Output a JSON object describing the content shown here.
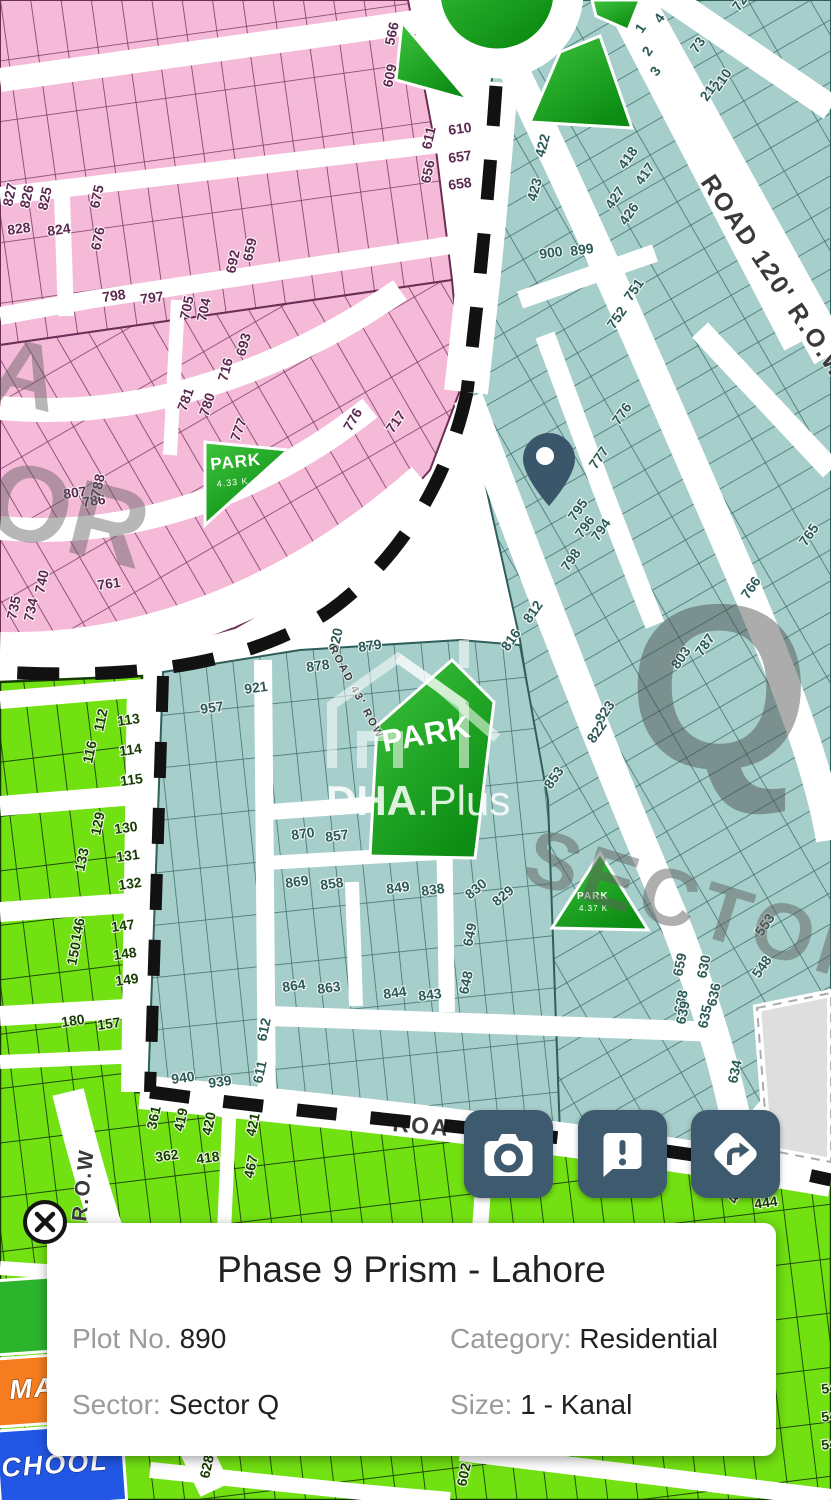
{
  "card": {
    "title": "Phase 9 Prism - Lahore",
    "fields": [
      {
        "label": "Plot No.",
        "value": "890"
      },
      {
        "label": "Category:",
        "value": "Residential"
      },
      {
        "label": "Sector:",
        "value": "Sector Q"
      },
      {
        "label": "Size:",
        "value": "1 - Kanal"
      }
    ]
  },
  "buttons": [
    {
      "name": "camera"
    },
    {
      "name": "feedback"
    },
    {
      "name": "directions"
    }
  ],
  "colors": {
    "accent": "#3d5a6e",
    "pin": "#3a566b",
    "plots_pink": "#f4bad8",
    "plots_teal": "#a6cecb",
    "plots_green": "#72e112",
    "park_green": "#0f9d14",
    "masjid_orange": "#f57d1f",
    "school_blue": "#2257e6",
    "vacant_gray": "#dedede",
    "boundary_dash": "#121212",
    "card_bg": "#ffffff",
    "label_gray": "#9b9b9b",
    "value_black": "#212121"
  },
  "map": {
    "watermarks": {
      "q": "Q",
      "sector": "SECTOR",
      "side_or": "OR",
      "side_a": "A",
      "brand_bold": "DHA",
      "brand_rest": ".Plus"
    },
    "road_labels": [
      {
        "t": "ROAD 120' R.O.W",
        "x": 700,
        "y": 182,
        "r": 56,
        "s": 25
      },
      {
        "t": "ROAD 43' ROW",
        "x": 329,
        "y": 648,
        "r": 62,
        "s": 11
      },
      {
        "t": "ROA",
        "x": 392,
        "y": 1131,
        "r": 5,
        "s": 23
      },
      {
        "t": "R.O.W",
        "x": 86,
        "y": 1222,
        "r": -84,
        "s": 21
      }
    ],
    "park_labels": [
      {
        "t": "PARK",
        "x": 384,
        "y": 752,
        "r": -10,
        "s": 31,
        "b": true
      },
      {
        "t": "PARK",
        "x": 211,
        "y": 470,
        "r": -6,
        "s": 17,
        "b": true
      },
      {
        "t": "4.33 K",
        "x": 217,
        "y": 487,
        "r": -6,
        "s": 9
      },
      {
        "t": "PARK",
        "x": 577,
        "y": 899,
        "r": 0,
        "s": 10,
        "b": true
      },
      {
        "t": "4.37 K",
        "x": 579,
        "y": 911,
        "r": 0,
        "s": 8
      }
    ],
    "facility_labels": [
      {
        "t": "MAS",
        "x": 10,
        "y": 1399,
        "r": -4,
        "s": 27
      },
      {
        "t": "CHOOL",
        "x": 2,
        "y": 1477,
        "r": -4,
        "s": 27
      }
    ],
    "plot_labels": [
      {
        "t": "566",
        "x": 394,
        "y": 46,
        "r": -78,
        "c": "p"
      },
      {
        "t": "609",
        "x": 392,
        "y": 88,
        "r": -78,
        "c": "p"
      },
      {
        "t": "610",
        "x": 449,
        "y": 135,
        "r": -8,
        "c": "p"
      },
      {
        "t": "611",
        "x": 431,
        "y": 150,
        "r": -78,
        "c": "p"
      },
      {
        "t": "657",
        "x": 449,
        "y": 163,
        "r": -8,
        "c": "p"
      },
      {
        "t": "656",
        "x": 430,
        "y": 184,
        "r": -78,
        "c": "p"
      },
      {
        "t": "658",
        "x": 449,
        "y": 190,
        "r": -8,
        "c": "p"
      },
      {
        "t": "827",
        "x": 12,
        "y": 207,
        "r": -78,
        "c": "p"
      },
      {
        "t": "826",
        "x": 29,
        "y": 209,
        "r": -78,
        "c": "p"
      },
      {
        "t": "825",
        "x": 47,
        "y": 211,
        "r": -78,
        "c": "p"
      },
      {
        "t": "828",
        "x": 8,
        "y": 235,
        "r": -8,
        "c": "p"
      },
      {
        "t": "824",
        "x": 48,
        "y": 236,
        "r": -8,
        "c": "p"
      },
      {
        "t": "675",
        "x": 99,
        "y": 209,
        "r": -78,
        "c": "p"
      },
      {
        "t": "676",
        "x": 100,
        "y": 251,
        "r": -78,
        "c": "p"
      },
      {
        "t": "692",
        "x": 235,
        "y": 274,
        "r": -78,
        "c": "p"
      },
      {
        "t": "659",
        "x": 252,
        "y": 262,
        "r": -78,
        "c": "p"
      },
      {
        "t": "798",
        "x": 103,
        "y": 302,
        "r": -8,
        "c": "p"
      },
      {
        "t": "797",
        "x": 141,
        "y": 304,
        "r": -8,
        "c": "p"
      },
      {
        "t": "705",
        "x": 189,
        "y": 320,
        "r": -78,
        "c": "p"
      },
      {
        "t": "704",
        "x": 206,
        "y": 322,
        "r": -78,
        "c": "p"
      },
      {
        "t": "716",
        "x": 227,
        "y": 382,
        "r": -75,
        "c": "p"
      },
      {
        "t": "693",
        "x": 245,
        "y": 357,
        "r": -75,
        "c": "p"
      },
      {
        "t": "781",
        "x": 186,
        "y": 412,
        "r": -70,
        "c": "p"
      },
      {
        "t": "780",
        "x": 208,
        "y": 417,
        "r": -72,
        "c": "p"
      },
      {
        "t": "777",
        "x": 239,
        "y": 442,
        "r": -70,
        "c": "p"
      },
      {
        "t": "776",
        "x": 351,
        "y": 432,
        "r": -60,
        "c": "p"
      },
      {
        "t": "717",
        "x": 393,
        "y": 434,
        "r": -55,
        "c": "p"
      },
      {
        "t": "786",
        "x": 83,
        "y": 507,
        "r": -8,
        "c": "p"
      },
      {
        "t": "788",
        "x": 100,
        "y": 498,
        "r": -78,
        "c": "p"
      },
      {
        "t": "807",
        "x": 64,
        "y": 499,
        "r": -8,
        "c": "p"
      },
      {
        "t": "761",
        "x": 98,
        "y": 590,
        "r": -8,
        "c": "p"
      },
      {
        "t": "740",
        "x": 44,
        "y": 594,
        "r": -78,
        "c": "p"
      },
      {
        "t": "735",
        "x": 16,
        "y": 620,
        "r": -78,
        "c": "p"
      },
      {
        "t": "734",
        "x": 33,
        "y": 622,
        "r": -78,
        "c": "p"
      },
      {
        "t": "4",
        "x": 661,
        "y": 24,
        "r": -55,
        "c": "t"
      },
      {
        "t": "1",
        "x": 642,
        "y": 34,
        "r": -55,
        "c": "t"
      },
      {
        "t": "2",
        "x": 649,
        "y": 57,
        "r": -55,
        "c": "t"
      },
      {
        "t": "3",
        "x": 657,
        "y": 77,
        "r": -55,
        "c": "t"
      },
      {
        "t": "72",
        "x": 739,
        "y": 12,
        "r": -55,
        "c": "t"
      },
      {
        "t": "73",
        "x": 697,
        "y": 54,
        "r": -55,
        "c": "t"
      },
      {
        "t": "211",
        "x": 707,
        "y": 102,
        "r": -55,
        "c": "t"
      },
      {
        "t": "210",
        "x": 719,
        "y": 92,
        "r": -55,
        "c": "t"
      },
      {
        "t": "418",
        "x": 625,
        "y": 170,
        "r": -55,
        "c": "t"
      },
      {
        "t": "417",
        "x": 642,
        "y": 186,
        "r": -55,
        "c": "t"
      },
      {
        "t": "427",
        "x": 612,
        "y": 210,
        "r": -55,
        "c": "t"
      },
      {
        "t": "426",
        "x": 626,
        "y": 226,
        "r": -55,
        "c": "t"
      },
      {
        "t": "422",
        "x": 544,
        "y": 158,
        "r": -75,
        "c": "t"
      },
      {
        "t": "423",
        "x": 536,
        "y": 202,
        "r": -75,
        "c": "t"
      },
      {
        "t": "900",
        "x": 540,
        "y": 259,
        "r": -8,
        "c": "t"
      },
      {
        "t": "899",
        "x": 571,
        "y": 256,
        "r": -8,
        "c": "t"
      },
      {
        "t": "751",
        "x": 631,
        "y": 302,
        "r": -55,
        "c": "t"
      },
      {
        "t": "752",
        "x": 614,
        "y": 330,
        "r": -55,
        "c": "t"
      },
      {
        "t": "776",
        "x": 619,
        "y": 426,
        "r": -55,
        "c": "t"
      },
      {
        "t": "777",
        "x": 596,
        "y": 470,
        "r": -55,
        "c": "t"
      },
      {
        "t": "795",
        "x": 575,
        "y": 522,
        "r": -55,
        "c": "t"
      },
      {
        "t": "796",
        "x": 582,
        "y": 539,
        "r": -55,
        "c": "t"
      },
      {
        "t": "794",
        "x": 598,
        "y": 542,
        "r": -55,
        "c": "t"
      },
      {
        "t": "798",
        "x": 568,
        "y": 572,
        "r": -55,
        "c": "t"
      },
      {
        "t": "812",
        "x": 530,
        "y": 624,
        "r": -55,
        "c": "t"
      },
      {
        "t": "816",
        "x": 508,
        "y": 652,
        "r": -55,
        "c": "t"
      },
      {
        "t": "765",
        "x": 806,
        "y": 547,
        "r": -55,
        "c": "t"
      },
      {
        "t": "766",
        "x": 748,
        "y": 600,
        "r": -55,
        "c": "t"
      },
      {
        "t": "787",
        "x": 702,
        "y": 657,
        "r": -55,
        "c": "t"
      },
      {
        "t": "803",
        "x": 678,
        "y": 670,
        "r": -55,
        "c": "t"
      },
      {
        "t": "823",
        "x": 602,
        "y": 724,
        "r": -55,
        "c": "t"
      },
      {
        "t": "822",
        "x": 594,
        "y": 744,
        "r": -55,
        "c": "t"
      },
      {
        "t": "853",
        "x": 551,
        "y": 790,
        "r": -55,
        "c": "t"
      },
      {
        "t": "921",
        "x": 245,
        "y": 694,
        "r": -8,
        "c": "t"
      },
      {
        "t": "957",
        "x": 201,
        "y": 714,
        "r": -8,
        "c": "t"
      },
      {
        "t": "879",
        "x": 359,
        "y": 652,
        "r": -8,
        "c": "t"
      },
      {
        "t": "920",
        "x": 338,
        "y": 652,
        "r": -78,
        "c": "t"
      },
      {
        "t": "878",
        "x": 307,
        "y": 672,
        "r": -8,
        "c": "t"
      },
      {
        "t": "870",
        "x": 292,
        "y": 840,
        "r": -8,
        "c": "t"
      },
      {
        "t": "857",
        "x": 326,
        "y": 842,
        "r": -8,
        "c": "t"
      },
      {
        "t": "869",
        "x": 286,
        "y": 888,
        "r": -8,
        "c": "t"
      },
      {
        "t": "858",
        "x": 321,
        "y": 890,
        "r": -8,
        "c": "t"
      },
      {
        "t": "849",
        "x": 387,
        "y": 894,
        "r": -8,
        "c": "t"
      },
      {
        "t": "838",
        "x": 422,
        "y": 896,
        "r": -8,
        "c": "t"
      },
      {
        "t": "830",
        "x": 470,
        "y": 900,
        "r": -40,
        "c": "t"
      },
      {
        "t": "829",
        "x": 497,
        "y": 907,
        "r": -40,
        "c": "t"
      },
      {
        "t": "864",
        "x": 283,
        "y": 992,
        "r": -8,
        "c": "t"
      },
      {
        "t": "863",
        "x": 318,
        "y": 994,
        "r": -8,
        "c": "t"
      },
      {
        "t": "844",
        "x": 384,
        "y": 999,
        "r": -8,
        "c": "t"
      },
      {
        "t": "843",
        "x": 419,
        "y": 1001,
        "r": -8,
        "c": "t"
      },
      {
        "t": "649",
        "x": 472,
        "y": 947,
        "r": -78,
        "c": "t"
      },
      {
        "t": "648",
        "x": 468,
        "y": 995,
        "r": -78,
        "c": "t"
      },
      {
        "t": "612",
        "x": 266,
        "y": 1042,
        "r": -78,
        "c": "t"
      },
      {
        "t": "611",
        "x": 262,
        "y": 1084,
        "r": -78,
        "c": "t"
      },
      {
        "t": "940",
        "x": 172,
        "y": 1084,
        "r": -8,
        "c": "t"
      },
      {
        "t": "939",
        "x": 209,
        "y": 1088,
        "r": -8,
        "c": "t"
      },
      {
        "t": "659",
        "x": 682,
        "y": 977,
        "r": -78,
        "c": "t"
      },
      {
        "t": "630",
        "x": 706,
        "y": 979,
        "r": -78,
        "c": "t"
      },
      {
        "t": "638",
        "x": 683,
        "y": 1014,
        "r": -78,
        "c": "t"
      },
      {
        "t": "636",
        "x": 716,
        "y": 1007,
        "r": -78,
        "c": "t"
      },
      {
        "t": "639",
        "x": 685,
        "y": 1025,
        "r": -78,
        "c": "t"
      },
      {
        "t": "635",
        "x": 707,
        "y": 1029,
        "r": -78,
        "c": "t"
      },
      {
        "t": "553",
        "x": 762,
        "y": 937,
        "r": -55,
        "c": "t"
      },
      {
        "t": "548",
        "x": 759,
        "y": 979,
        "r": -55,
        "c": "t"
      },
      {
        "t": "634",
        "x": 737,
        "y": 1084,
        "r": -78,
        "c": "t"
      },
      {
        "t": "113",
        "x": 118,
        "y": 726,
        "r": -8,
        "c": "g",
        "s": 16
      },
      {
        "t": "114",
        "x": 120,
        "y": 756,
        "r": -8,
        "c": "g",
        "s": 16
      },
      {
        "t": "115",
        "x": 121,
        "y": 786,
        "r": -8,
        "c": "g",
        "s": 16
      },
      {
        "t": "112",
        "x": 103,
        "y": 732,
        "r": -78,
        "c": "g",
        "s": 15
      },
      {
        "t": "116",
        "x": 92,
        "y": 764,
        "r": -78,
        "c": "g",
        "s": 15
      },
      {
        "t": "130",
        "x": 115,
        "y": 834,
        "r": -8,
        "c": "g",
        "s": 16
      },
      {
        "t": "131",
        "x": 117,
        "y": 862,
        "r": -8,
        "c": "g",
        "s": 16
      },
      {
        "t": "132",
        "x": 119,
        "y": 890,
        "r": -8,
        "c": "g",
        "s": 16
      },
      {
        "t": "129",
        "x": 100,
        "y": 836,
        "r": -78,
        "c": "g",
        "s": 15
      },
      {
        "t": "133",
        "x": 84,
        "y": 872,
        "r": -78,
        "c": "g",
        "s": 15
      },
      {
        "t": "147",
        "x": 112,
        "y": 932,
        "r": -8,
        "c": "g",
        "s": 16
      },
      {
        "t": "148",
        "x": 114,
        "y": 960,
        "r": -8,
        "c": "g",
        "s": 16
      },
      {
        "t": "149",
        "x": 116,
        "y": 986,
        "r": -8,
        "c": "g",
        "s": 16
      },
      {
        "t": "146",
        "x": 80,
        "y": 942,
        "r": -78,
        "c": "g",
        "s": 15
      },
      {
        "t": "150",
        "x": 76,
        "y": 966,
        "r": -78,
        "c": "g",
        "s": 15
      },
      {
        "t": "180",
        "x": 62,
        "y": 1027,
        "r": -8,
        "c": "g",
        "s": 16
      },
      {
        "t": "157",
        "x": 98,
        "y": 1030,
        "r": -8,
        "c": "g",
        "s": 16
      },
      {
        "t": "361",
        "x": 156,
        "y": 1130,
        "r": -78,
        "c": "g"
      },
      {
        "t": "419",
        "x": 183,
        "y": 1132,
        "r": -78,
        "c": "g"
      },
      {
        "t": "420",
        "x": 211,
        "y": 1136,
        "r": -78,
        "c": "g"
      },
      {
        "t": "362",
        "x": 156,
        "y": 1162,
        "r": -8,
        "c": "g",
        "s": 16
      },
      {
        "t": "418",
        "x": 197,
        "y": 1164,
        "r": -8,
        "c": "g",
        "s": 16
      },
      {
        "t": "421",
        "x": 255,
        "y": 1137,
        "r": -78,
        "c": "g"
      },
      {
        "t": "467",
        "x": 253,
        "y": 1179,
        "r": -78,
        "c": "g"
      },
      {
        "t": "444",
        "x": 755,
        "y": 1209,
        "r": -8,
        "c": "g"
      },
      {
        "t": "46",
        "x": 737,
        "y": 1204,
        "r": -78,
        "c": "g"
      },
      {
        "t": "628",
        "x": 209,
        "y": 1479,
        "r": -78,
        "c": "g"
      },
      {
        "t": "602",
        "x": 466,
        "y": 1487,
        "r": -78,
        "c": "g"
      },
      {
        "t": "546",
        "x": 822,
        "y": 1394,
        "r": -8,
        "c": "g"
      },
      {
        "t": "547",
        "x": 822,
        "y": 1422,
        "r": -8,
        "c": "g"
      },
      {
        "t": "548",
        "x": 822,
        "y": 1450,
        "r": -8,
        "c": "g"
      }
    ]
  }
}
